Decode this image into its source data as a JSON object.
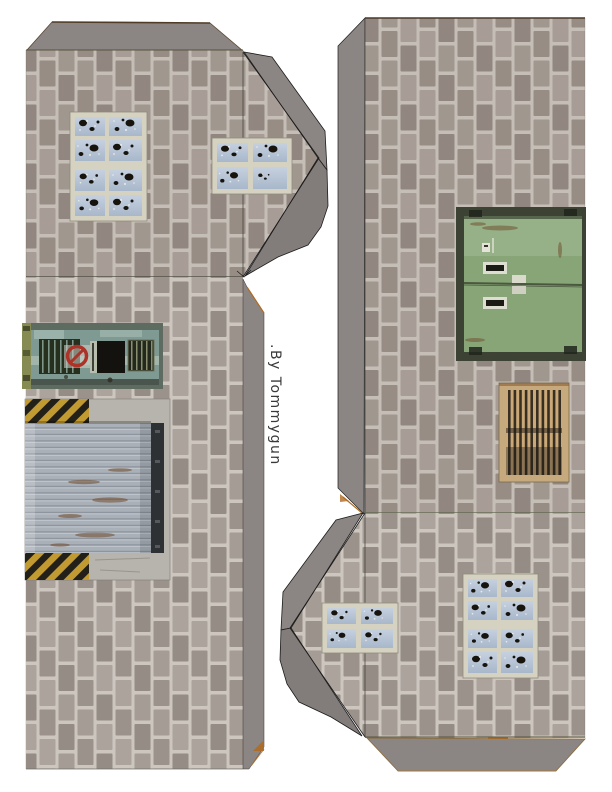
{
  "credit": {
    "text": ".By Tommygun"
  },
  "colors": {
    "ink": "#3a3a3a",
    "mortar": "#ccc6bf",
    "brick1": "#a59c95",
    "brick2": "#9b928b",
    "brick3": "#aca39c",
    "brick4": "#958c85",
    "flap": "#8b8583",
    "flapDark": "#827c7a",
    "concrete": "#b7b4ae",
    "hazardYellow": "#c19b31",
    "hazardBlack": "#23201a",
    "roller": "#a9b0b8",
    "rust": "#6f4a2c",
    "doorTeal": "#7e9a92",
    "doorGreen": "#87a577",
    "louverFrame": "#c6a97c",
    "windowFrame": "#d6d2c2",
    "paneTop": "#c6d1df",
    "paneBottom": "#a8b7cb",
    "edgeOrange": "#b06a20"
  }
}
